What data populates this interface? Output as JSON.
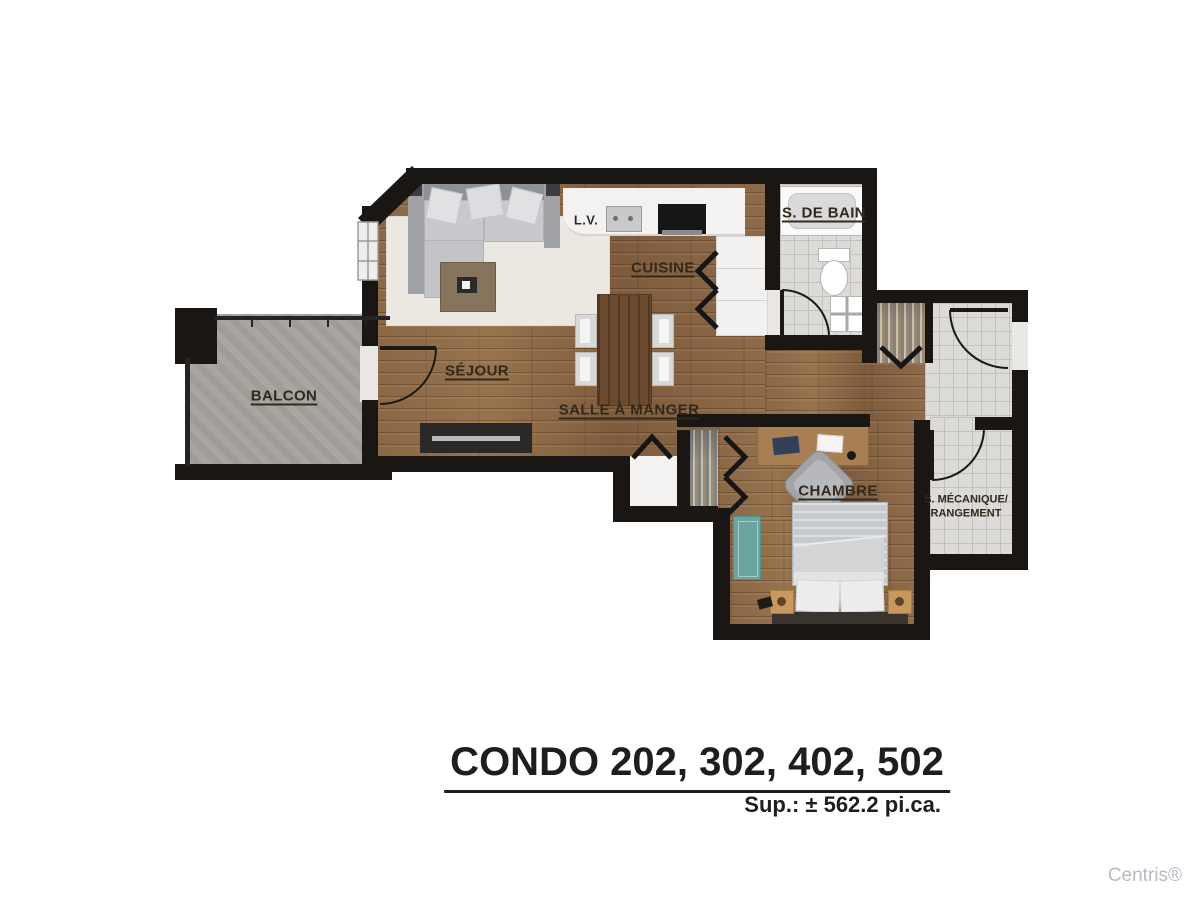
{
  "plan": {
    "labels": {
      "balcony": "BALCON",
      "living": "SÉJOUR",
      "dining": "SALLE À MANGER",
      "kitchen": "CUISINE",
      "bathroom": "S. DE BAIN",
      "bedroom": "CHAMBRE",
      "mechanical_line1": "S. MÉCANIQUE/",
      "mechanical_line2": "RANGEMENT",
      "dishwasher": "L.V."
    }
  },
  "footer": {
    "title": "CONDO 202, 302, 402, 502",
    "area": "Sup.: ± 562.2 pi.ca.",
    "watermark": "Centris®"
  },
  "colors": {
    "wall": "#1a1613",
    "wood": "#8b6849",
    "tile": "#dcdbd8",
    "balcony": "#a6a29d",
    "rug": "#ebe8e1",
    "counter": "#f3f2f0",
    "accent_teal": "#6ba5a1",
    "label": "#33281c",
    "title": "#1e1e1e",
    "watermark": "#b7bac3"
  }
}
